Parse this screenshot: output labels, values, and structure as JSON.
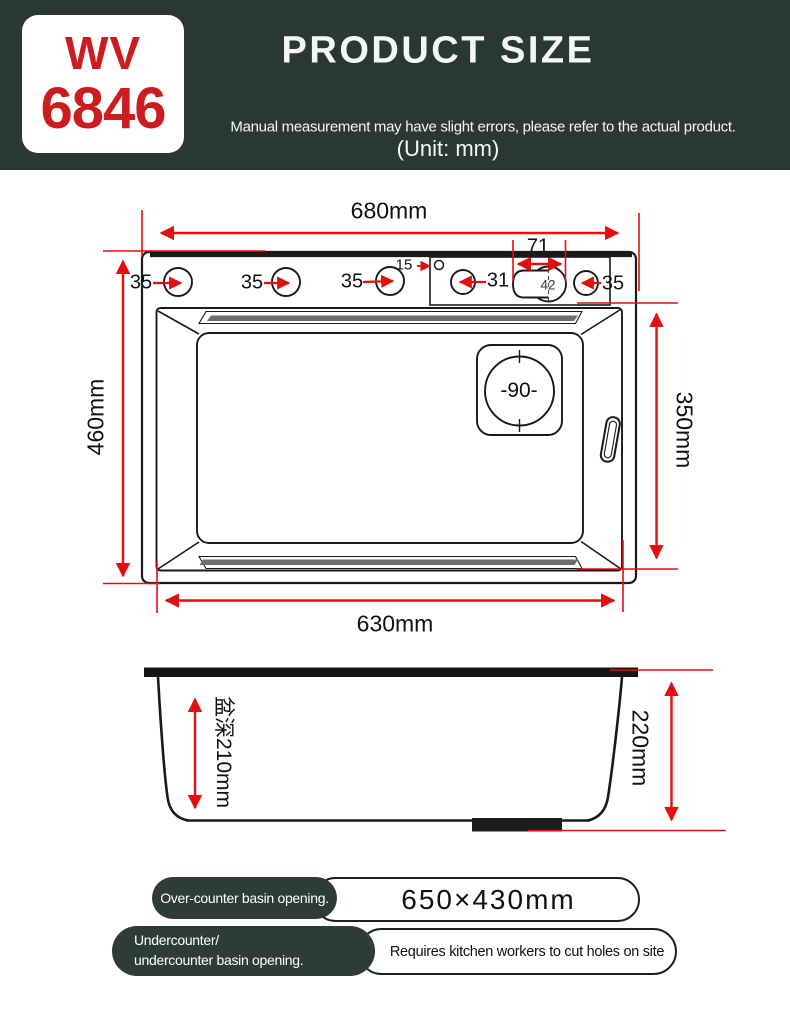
{
  "header": {
    "model_line1": "WV",
    "model_line2": "6846",
    "title": "PRODUCT SIZE",
    "subtitle": "Manual measurement may have slight errors, please refer to the actual product.",
    "unit": "(Unit: mm)"
  },
  "top_view": {
    "width_top": "680mm",
    "width_bottom": "630mm",
    "height_left": "460mm",
    "height_right": "350mm",
    "hole_35_a": "35",
    "hole_35_b": "35",
    "hole_35_c": "35",
    "hole_15": "15",
    "hole_31": "31",
    "keyhole_width": "71",
    "keyhole_diameter": "42",
    "hole_35_d": "35",
    "drain_diameter": "-90-"
  },
  "side_view": {
    "basin_depth": "盆深210mm",
    "overall_height": "220mm"
  },
  "footer": {
    "over_counter_label": "Over-counter basin opening.",
    "over_counter_value": "650×430mm",
    "undercounter_label_line1": "Undercounter/",
    "undercounter_label_line2": "undercounter basin opening.",
    "undercounter_note": "Requires kitchen workers to cut holes on site"
  },
  "colors": {
    "header_bg": "#293931",
    "pill_bg": "#2d3c36",
    "dimension_red": "#e30e0e",
    "brand_red": "#cd1c20",
    "line_black": "#1a1a1a"
  }
}
